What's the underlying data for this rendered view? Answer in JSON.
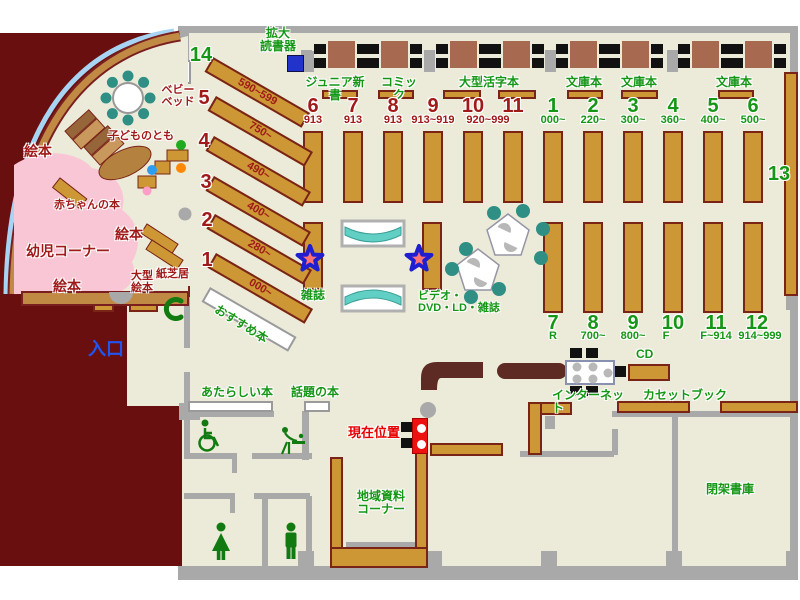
{
  "colors": {
    "floor": "#ecebda",
    "wall": "#a9a9a9",
    "maroon": "#6a0f0f",
    "shelf": "#cc9734",
    "shelf_border": "#7a2418",
    "green_text": "#169616",
    "dark_red_text": "#a01a1a",
    "pink_area": "#f8c6d5",
    "teal_seat": "#2f8f85",
    "entrance_blue": "#2255ee",
    "marker_red": "#ee1111",
    "counter": "#5e2b24",
    "outer_arc_blue": "#a8d4f4",
    "star_fill": "#ff7373",
    "star_stroke": "#1f1fcf"
  },
  "children": {
    "ehon1": "絵本",
    "ehon2": "絵本",
    "ehon3": "絵本",
    "baby_books": "赤ちゃんの本",
    "toddler_corner": "幼児コーナー",
    "kodomo": "子どものとも",
    "baby_bed": "ベビー\nベッド",
    "large_ehon": "大型\n絵本",
    "kamishibai": "紙芝居"
  },
  "device": {
    "magnifier": "拡大\n読書器"
  },
  "diagonal": [
    {
      "num": "14",
      "range": "590~599"
    },
    {
      "num": "5",
      "range": "750~"
    },
    {
      "num": "4",
      "range": "490~"
    },
    {
      "num": "3",
      "range": "400~"
    },
    {
      "num": "2",
      "range": "280~"
    },
    {
      "num": "1",
      "range": "000~"
    }
  ],
  "recommended": "おすすめ本",
  "sections": [
    "ジュニア新書",
    "コミック",
    "大型活字本",
    "文庫本",
    "文庫本",
    "文庫本"
  ],
  "rows": {
    "red": [
      {
        "num": "6",
        "range": "913"
      },
      {
        "num": "7",
        "range": "913"
      },
      {
        "num": "8",
        "range": "913"
      },
      {
        "num": "9",
        "range": "913~919"
      },
      {
        "num": "10",
        "range": "920~999"
      },
      {
        "num": "11",
        "range": ""
      }
    ],
    "green_top": [
      {
        "num": "1",
        "range": "000~"
      },
      {
        "num": "2",
        "range": "220~"
      },
      {
        "num": "3",
        "range": "300~"
      },
      {
        "num": "4",
        "range": "360~"
      },
      {
        "num": "5",
        "range": "400~"
      },
      {
        "num": "6",
        "range": "500~"
      }
    ],
    "green_bottom": [
      {
        "num": "7",
        "range": "R"
      },
      {
        "num": "8",
        "range": "700~"
      },
      {
        "num": "9",
        "range": "800~"
      },
      {
        "num": "10",
        "range": "F"
      },
      {
        "num": "11",
        "range": "F~914"
      },
      {
        "num": "12",
        "range": "914~999"
      }
    ]
  },
  "shelf13": "13",
  "magazine": "雑誌",
  "video": "ビデオ・\nDVD・LD・雑誌",
  "entrance": "入口",
  "new_books": "あたらしい本",
  "topic_books": "話題の本",
  "current_location": "現在位置",
  "local_corner": "地域資料\nコーナー",
  "closed_stacks": "閉架書庫",
  "internet": "インターネット",
  "cassette": "カセットブック",
  "cd": "CD"
}
